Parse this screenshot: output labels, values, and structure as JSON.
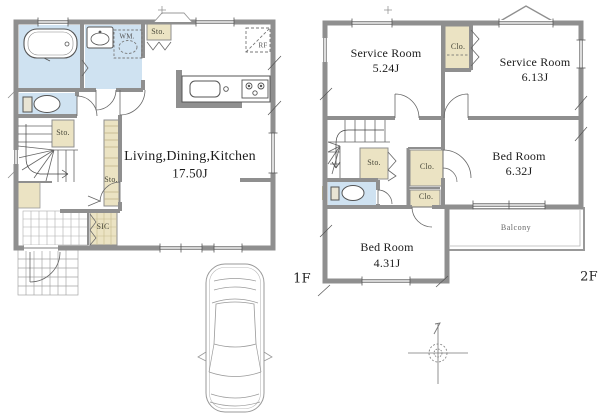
{
  "meta": {
    "type": "real-estate floor plan, two floors with parking and compass"
  },
  "colors": {
    "wall_gray": "#8f8f8f",
    "wet_room_blue": "#cfe2f1",
    "storage_tan": "#ebe3c3",
    "line_dark": "#555555"
  },
  "floor1": {
    "floor_label": "1F",
    "ldk": {
      "name": "Living,Dining,Kitchen",
      "area": "17.50J"
    },
    "labels": {
      "sto_top": "Sto.",
      "washing_machine": "WM.",
      "refrigerator": "RF",
      "sto_mid": "Sto.",
      "sto_hall": "Sto.",
      "sic": "SIC"
    }
  },
  "floor2": {
    "floor_label": "2F",
    "rooms": {
      "service_room_1": {
        "name": "Service Room",
        "area": "5.24J"
      },
      "service_room_2": {
        "name": "Service Room",
        "area": "6.13J"
      },
      "bed_room_1": {
        "name": "Bed Room",
        "area": "6.32J"
      },
      "bed_room_2": {
        "name": "Bed Room",
        "area": "4.31J"
      },
      "balcony": {
        "name": "Balcony"
      }
    },
    "labels": {
      "clo_top": "Clo.",
      "sto": "Sto.",
      "clo_1": "Clo.",
      "clo_2": "Clo."
    }
  }
}
